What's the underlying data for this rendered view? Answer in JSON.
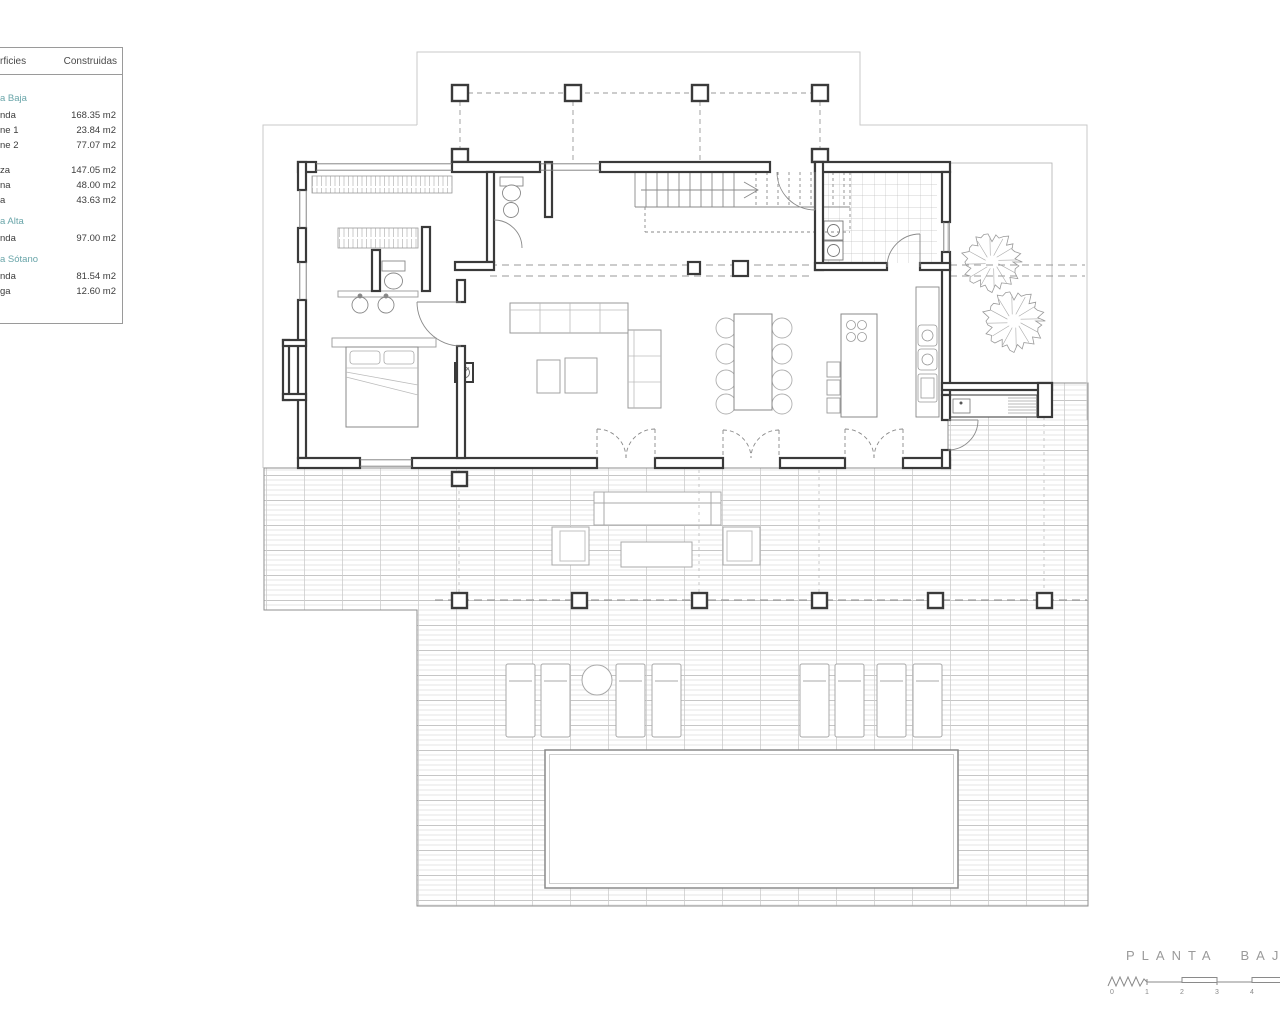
{
  "legend": {
    "header": {
      "col_left": "rficies",
      "col_right": "Construidas"
    },
    "sections": [
      {
        "title": "a Baja",
        "rows": [
          {
            "label": "nda",
            "value": "168.35 m2"
          },
          {
            "label": "ne 1",
            "value": "23.84 m2"
          },
          {
            "label": "ne 2",
            "value": "77.07 m2"
          },
          {
            "label": "za",
            "value": "147.05 m2",
            "gap_before": true
          },
          {
            "label": "na",
            "value": "48.00 m2"
          },
          {
            "label": "a",
            "value": "43.63 m2"
          }
        ]
      },
      {
        "title": "a Alta",
        "rows": [
          {
            "label": "nda",
            "value": "97.00 m2"
          }
        ]
      },
      {
        "title": "a Sótano",
        "rows": [
          {
            "label": "nda",
            "value": "81.54 m2"
          },
          {
            "label": "ga",
            "value": "12.60 m2"
          }
        ]
      }
    ],
    "accent_color": "#69a5a9",
    "text_color": "#3c3c3c"
  },
  "title_block": {
    "title": "PLANTA BAJA",
    "title_color": "#9a9a9a",
    "scale_numbers": [
      "0",
      "1",
      "2",
      "3",
      "4"
    ]
  },
  "plan": {
    "wall_color": "#3a3a3a",
    "thin_line_color": "#8a8a8a",
    "light_outline_color": "#c9c9c9"
  }
}
